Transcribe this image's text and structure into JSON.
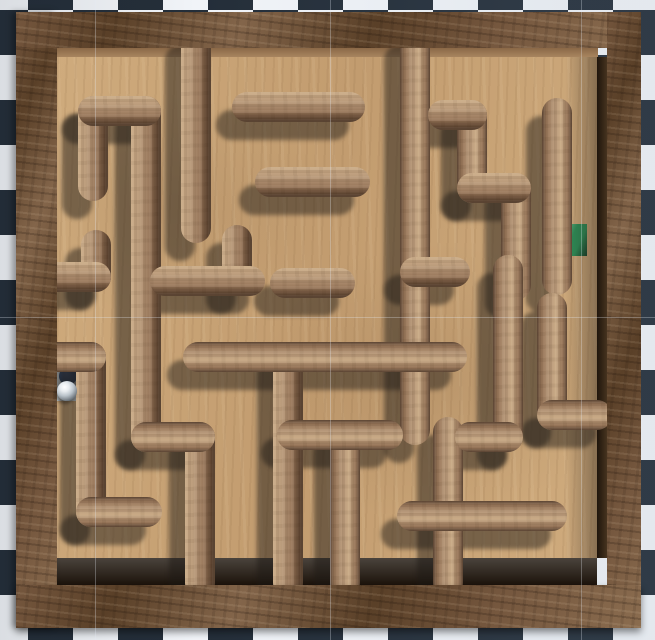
{
  "scene": {
    "name": "wooden-ball-maze-top-view",
    "width": 655,
    "height": 640
  },
  "background": {
    "checker": {
      "size": 45,
      "origin_x": 28,
      "origin_y": 10,
      "dark": "#242e39",
      "light": "#f1f4f8"
    },
    "editor_gridlines": {
      "color": "rgba(228,234,244,0.30)",
      "vertical_x": [
        95,
        330,
        581
      ],
      "horizontal_y": [
        317
      ]
    }
  },
  "board": {
    "frame": {
      "left": {
        "x": 16,
        "y": 12,
        "w": 41,
        "h": 616
      },
      "top": {
        "x": 16,
        "y": 12,
        "w": 625,
        "h": 36
      },
      "right": {
        "x": 607,
        "y": 12,
        "w": 34,
        "h": 616
      },
      "bottom": {
        "x": 16,
        "y": 585,
        "w": 625,
        "h": 43
      },
      "wood1": "#75573e",
      "wood2": "#5a4028",
      "wood3": "#83654a",
      "wood4": "#8a6c4f"
    },
    "floor": {
      "x": 57,
      "y": 57,
      "w": 540,
      "h": 501,
      "base": "#cfab7d",
      "mid": "#c29c6f"
    },
    "faces": {
      "top": {
        "x": 48,
        "y": 48,
        "w": 550,
        "h": 9,
        "from": "#8a6847",
        "to": "#a8855f",
        "dir": "180deg"
      },
      "left": {
        "x": 48,
        "y": 57,
        "w": 9,
        "h": 501,
        "from": "#7b5c40",
        "to": "#8f6e4e",
        "dir": "90deg"
      },
      "right": {
        "x": 597,
        "y": 57,
        "w": 10,
        "h": 501,
        "from": "#1f150c",
        "to": "#46331f",
        "dir": "90deg"
      },
      "bottom": {
        "x": 57,
        "y": 558,
        "w": 540,
        "h": 27,
        "from": "#4a433c",
        "to": "#1c130b",
        "dir": "180deg"
      }
    },
    "frame_shadow_band": {
      "x": 565,
      "y": 57,
      "w": 32,
      "h": 501,
      "color": "rgba(40,31,24,0.42)"
    }
  },
  "maze": {
    "wall_thickness": 30,
    "cap_radius": 15,
    "wood_light": "#c9aa86",
    "wood_lighter": "#bb9c7c",
    "wood_mid": "#97765a",
    "wood_dark": "#4e3726",
    "shadow": {
      "dx": -16,
      "dy": 18,
      "color": "rgba(30,25,21,0.48)"
    },
    "shading_center": {
      "x": 330,
      "y": 322
    },
    "walls": [
      [
        "v",
        196,
        42,
        196,
        228
      ],
      [
        "v",
        415,
        42,
        415,
        430
      ],
      [
        "v",
        93,
        111,
        93,
        186
      ],
      [
        "v",
        146,
        111,
        146,
        437
      ],
      [
        "v",
        96,
        245,
        96,
        277
      ],
      [
        "v",
        91,
        357,
        91,
        512
      ],
      [
        "v",
        237,
        240,
        237,
        281
      ],
      [
        "v",
        288,
        357,
        288,
        583
      ],
      [
        "v",
        345,
        435,
        345,
        583
      ],
      [
        "v",
        448,
        432,
        448,
        583
      ],
      [
        "v",
        472,
        115,
        472,
        188
      ],
      [
        "v",
        516,
        188,
        516,
        285
      ],
      [
        "v",
        557,
        113,
        557,
        280
      ],
      [
        "v",
        508,
        270,
        508,
        437
      ],
      [
        "v",
        552,
        308,
        552,
        415
      ],
      [
        "v",
        200,
        437,
        200,
        583
      ],
      [
        "h",
        247,
        107,
        350,
        107
      ],
      [
        "h",
        93,
        111,
        146,
        111
      ],
      [
        "h",
        52,
        277,
        96,
        277
      ],
      [
        "h",
        52,
        357,
        91,
        357
      ],
      [
        "h",
        91,
        512,
        147,
        512
      ],
      [
        "h",
        165,
        281,
        250,
        281
      ],
      [
        "h",
        285,
        283,
        340,
        283
      ],
      [
        "h",
        270,
        182,
        355,
        182
      ],
      [
        "h",
        198,
        357,
        452,
        357
      ],
      [
        "h",
        146,
        437,
        200,
        437
      ],
      [
        "h",
        292,
        435,
        388,
        435
      ],
      [
        "h",
        412,
        516,
        552,
        516
      ],
      [
        "h",
        415,
        272,
        455,
        272
      ],
      [
        "h",
        443,
        115,
        472,
        115
      ],
      [
        "h",
        472,
        188,
        516,
        188
      ],
      [
        "h",
        470,
        437,
        508,
        437
      ],
      [
        "h",
        552,
        415,
        597,
        415
      ]
    ]
  },
  "start": {
    "pad": {
      "x": 56,
      "y": 362,
      "w": 23,
      "h": 39,
      "color": "#dde6ea"
    },
    "dot": {
      "cx": 68,
      "cy": 376,
      "r": 9,
      "inner": "#27456e",
      "rim": "#48679a"
    }
  },
  "goal": {
    "pad": {
      "x": 566,
      "y": 224,
      "w": 21,
      "h": 32,
      "color": "#2e8f58",
      "light": "#6ab287",
      "dark": "#16452c"
    }
  },
  "ball": {
    "cx": 67,
    "cy": 391,
    "r": 10,
    "highlight": "#ffffff",
    "mid": "#b9c2c9",
    "dark": "#3e464e"
  }
}
